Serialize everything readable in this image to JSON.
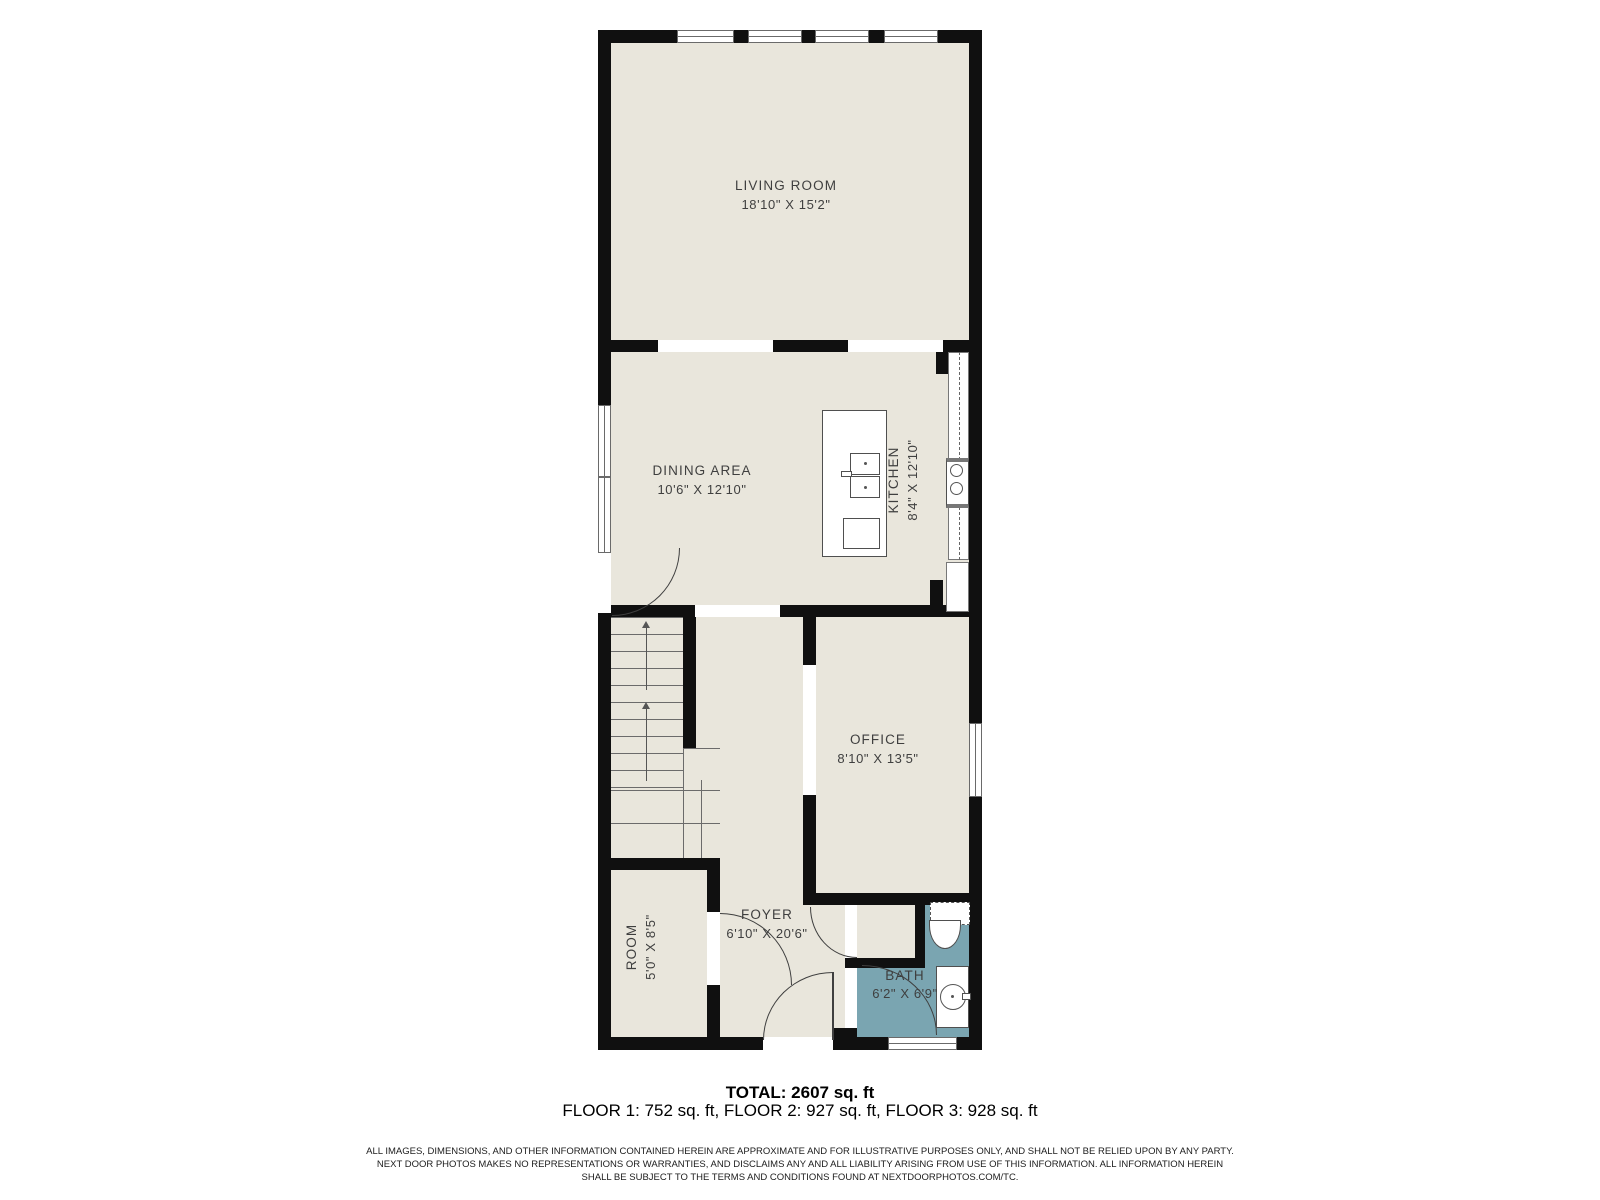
{
  "plan": {
    "rooms": {
      "living": {
        "name": "LIVING ROOM",
        "dims": "18'10\" X 15'2\""
      },
      "dining": {
        "name": "DINING AREA",
        "dims": "10'6\" X 12'10\""
      },
      "kitchen": {
        "name": "KITCHEN",
        "dims": "8'4\" X 12'10\""
      },
      "office": {
        "name": "OFFICE",
        "dims": "8'10\" X 13'5\""
      },
      "room": {
        "name": "ROOM",
        "dims": "5'0\" X 8'5\""
      },
      "foyer": {
        "name": "FOYER",
        "dims": "6'10\" X 20'6\""
      },
      "bath": {
        "name": "BATH",
        "dims": "6'2\" X 6'9\""
      }
    },
    "colors": {
      "floor": "#e9e6dc",
      "wall": "#101010",
      "bath": "#7aa5b1",
      "label": "#3f3f3f",
      "fixture": "#4f4f4f"
    }
  },
  "summary": {
    "total": "TOTAL: 2607 sq. ft",
    "floors": "FLOOR 1: 752 sq. ft, FLOOR 2: 927 sq. ft, FLOOR 3: 928 sq. ft"
  },
  "disclaimer": {
    "line1": "ALL IMAGES, DIMENSIONS, AND OTHER INFORMATION CONTAINED HEREIN ARE APPROXIMATE AND FOR ILLUSTRATIVE PURPOSES ONLY, AND SHALL NOT BE RELIED UPON BY ANY PARTY.",
    "line2": "NEXT DOOR PHOTOS MAKES NO REPRESENTATIONS OR WARRANTIES, AND DISCLAIMS ANY AND ALL LIABILITY ARISING FROM USE OF THIS INFORMATION. ALL INFORMATION HEREIN",
    "line3": "SHALL BE SUBJECT TO THE TERMS AND CONDITIONS FOUND AT NEXTDOORPHOTOS.COM/TC."
  }
}
